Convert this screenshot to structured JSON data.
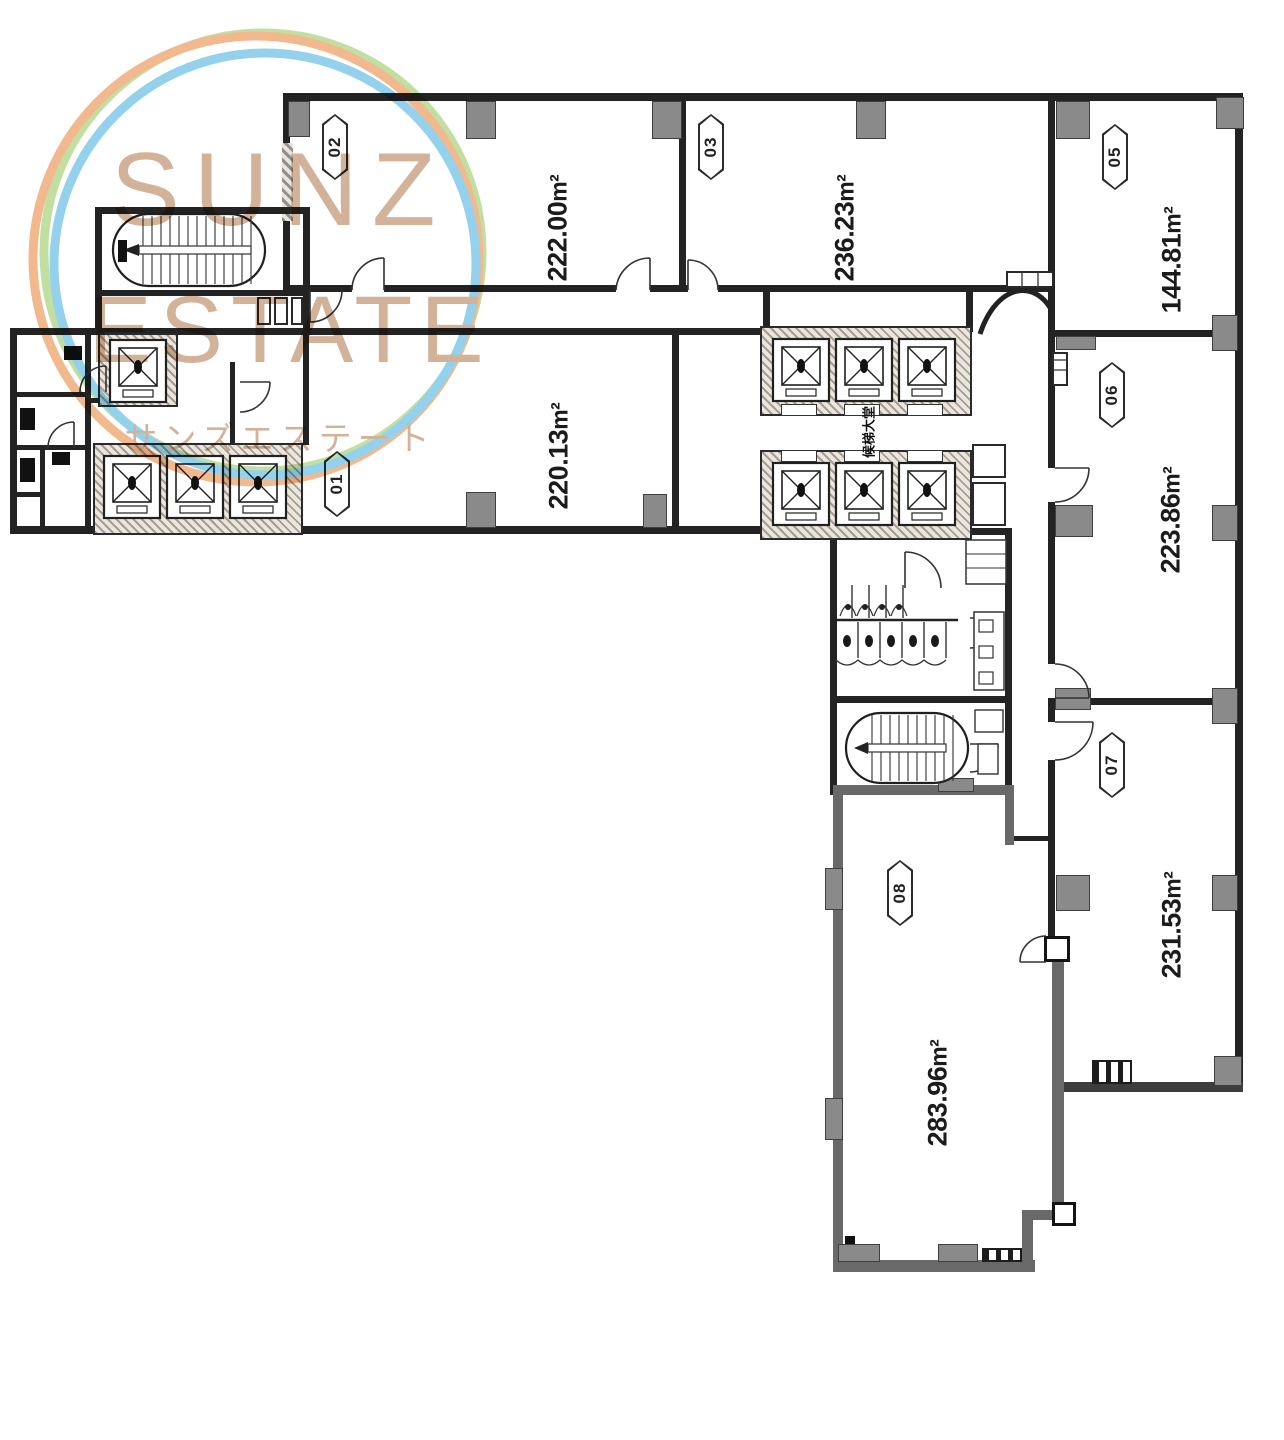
{
  "watermark": {
    "title_line1": "SUNZ",
    "title_line2": "ESTATE",
    "subtitle": "サンズエステート"
  },
  "plan": {
    "unit_label": "m²",
    "elevator_lobby_label": "候梯大堂",
    "rooms": [
      {
        "number": "01",
        "area": "220.13"
      },
      {
        "number": "02",
        "area": "222.00"
      },
      {
        "number": "03",
        "area": "236.23"
      },
      {
        "number": "05",
        "area": "144.81"
      },
      {
        "number": "06",
        "area": "223.86"
      },
      {
        "number": "07",
        "area": "231.53"
      },
      {
        "number": "08",
        "area": "283.96"
      }
    ]
  },
  "colors": {
    "wall": "#232323",
    "unit08_wall": "#696969",
    "door_block": "#8a8a8a",
    "logo_text": "#c9a184",
    "ring_orange": "#f0a875",
    "ring_blue": "#7cc7e8",
    "ring_green": "#b5d88d"
  }
}
